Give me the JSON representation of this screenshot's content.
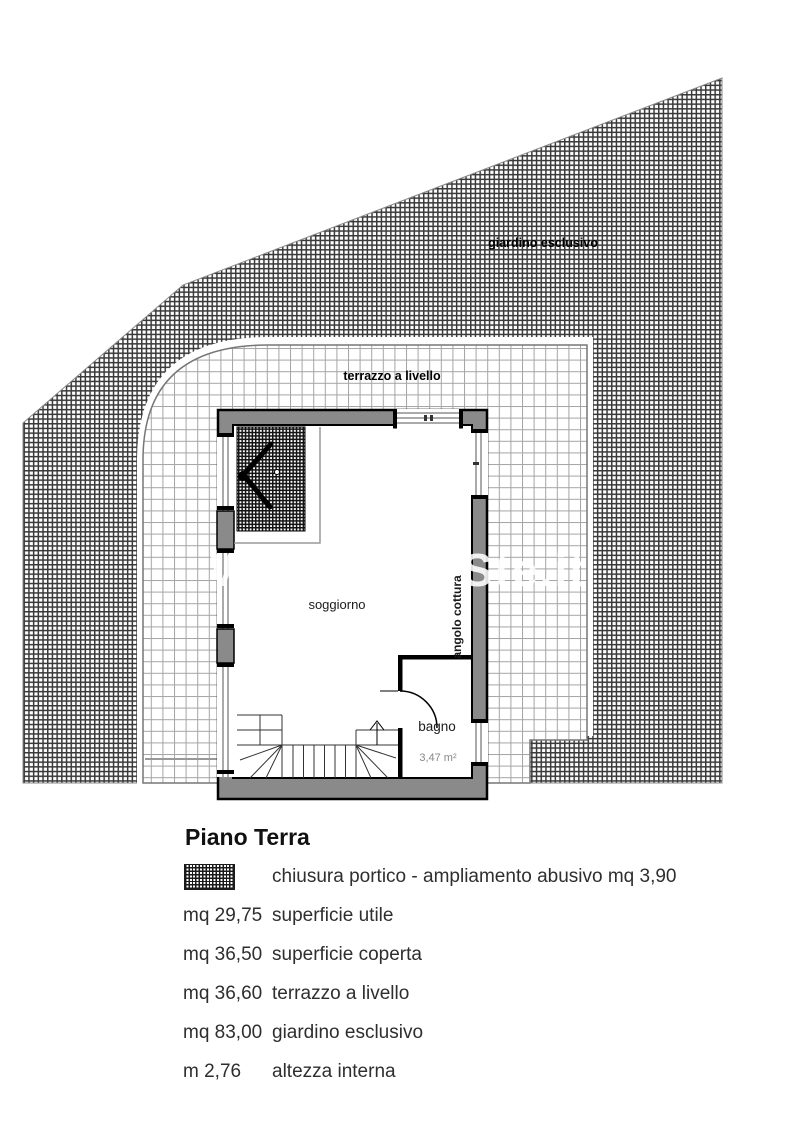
{
  "plan": {
    "garden_label": "giardino esclusivo",
    "terrace_label": "terrazzo a livello",
    "living_room_label": "soggiorno",
    "kitchen_label": "angolo cottura",
    "bathroom_label": "bagno",
    "bathroom_area": "3,47 m²",
    "watermark_left": "W",
    "watermark_right": "Ste.it"
  },
  "legend": {
    "title": "Piano Terra",
    "swatch_label": "chiusura portico - ampliamento abusivo mq 3,90",
    "rows": [
      {
        "value": "mq 29,75",
        "label": "superficie utile"
      },
      {
        "value": "mq 36,50",
        "label": "superficie coperta"
      },
      {
        "value": "mq 36,60",
        "label": "terrazzo a livello"
      },
      {
        "value": "mq 83,00",
        "label": "giardino esclusivo"
      },
      {
        "value": "m 2,76",
        "label": "altezza interna"
      }
    ]
  },
  "colors": {
    "wall_gray": "#8a8a8a",
    "hatch_dark": "#2f2f2f",
    "tile_line": "#a5a5a5",
    "outline_black": "#000000",
    "faint_text": "#888888"
  }
}
